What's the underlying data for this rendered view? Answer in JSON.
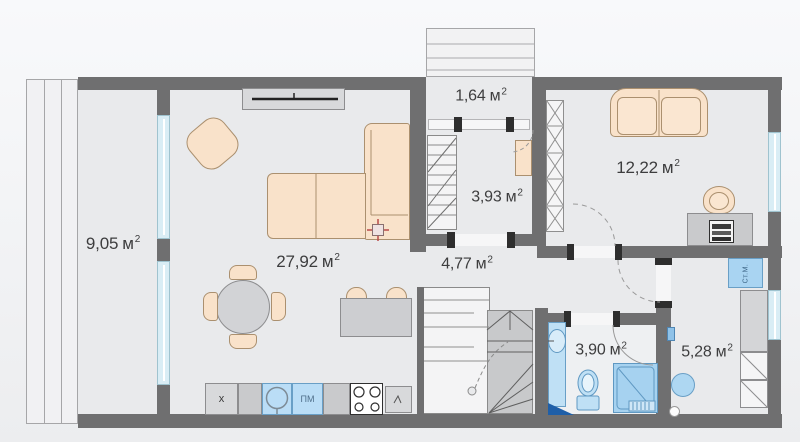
{
  "plan": {
    "unit": {
      "symbol": "м",
      "exponent": "2"
    },
    "rooms": [
      {
        "id": "terrace",
        "area": "9,05"
      },
      {
        "id": "living-kitchen",
        "area": "27,92"
      },
      {
        "id": "balcony",
        "area": "1,64"
      },
      {
        "id": "entry",
        "area": "3,93"
      },
      {
        "id": "hallway",
        "area": "4,77"
      },
      {
        "id": "bedroom",
        "area": "12,22"
      },
      {
        "id": "bathroom",
        "area": "3,90"
      },
      {
        "id": "utility",
        "area": "5,28"
      }
    ],
    "appliance_labels": {
      "dishwasher": "ПМ",
      "washing_machine": "Ст.М.",
      "kitchen_cabinet": "x"
    },
    "colors": {
      "wall": "#6f6f70",
      "floor": "#e9eaec",
      "furniture": "#f9e2ca",
      "plumbing": "#aed7f2",
      "window": "#d9edf5",
      "outlet_accent": "#b94a4a"
    }
  }
}
